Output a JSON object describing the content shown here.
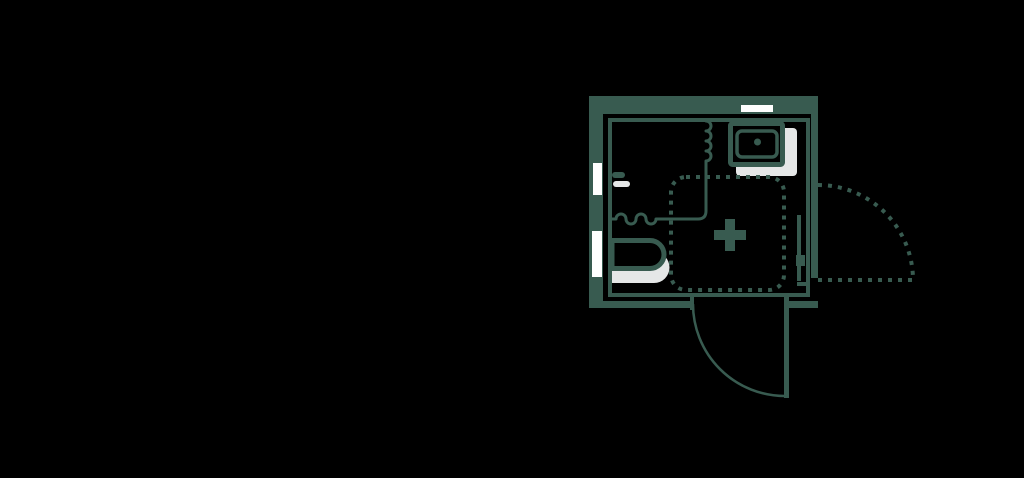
{
  "colors": {
    "background": "#000000",
    "wall": "#385B50",
    "shadow": "#E5E7E7",
    "opening": "#FFFFFF"
  },
  "plan": {
    "type": "bathroom-floor-plan",
    "fixtures": [
      {
        "name": "washbasin",
        "icon": "sink-icon"
      },
      {
        "name": "toilet",
        "icon": "toilet-icon"
      },
      {
        "name": "shower-area",
        "icon": "dashed-square-plus-icon"
      },
      {
        "name": "shower-curtain",
        "icon": "zigzag-line-icon"
      },
      {
        "name": "toilet-roll-holder",
        "icon": "wall-stub-icon"
      },
      {
        "name": "wall-radiator",
        "icon": "wall-line-icon"
      },
      {
        "name": "window-top",
        "icon": "wall-opening-icon"
      },
      {
        "name": "window-left-upper",
        "icon": "wall-opening-icon"
      },
      {
        "name": "window-left-lower",
        "icon": "wall-opening-icon"
      },
      {
        "name": "door-bottom",
        "icon": "door-swing-arc-icon"
      },
      {
        "name": "door-right",
        "icon": "dashed-door-swing-arc-icon"
      }
    ]
  }
}
